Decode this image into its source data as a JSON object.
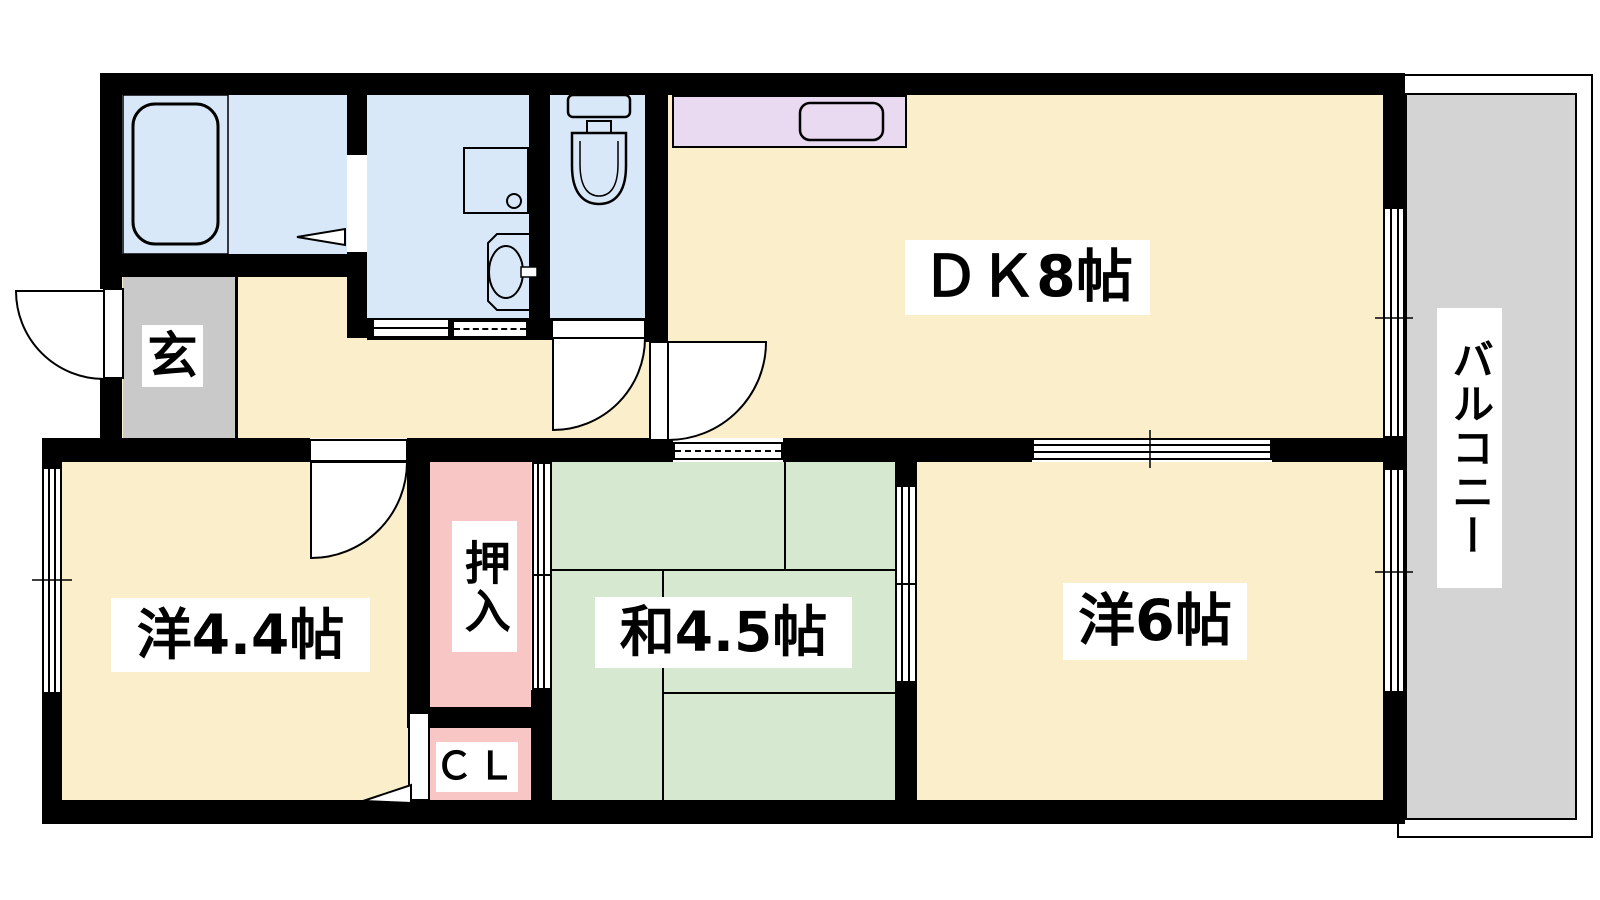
{
  "plan": {
    "kind": "apartment floor plan",
    "rooms": {
      "dk": {
        "label": "ＤＫ8帖",
        "tatami": 8
      },
      "western_4_4": {
        "label": "洋4.4帖",
        "tatami": 4.4
      },
      "japanese_4_5": {
        "label": "和4.5帖",
        "tatami": 4.5
      },
      "western_6": {
        "label": "洋6帖",
        "tatami": 6
      },
      "genkan": {
        "label": "玄"
      },
      "oshiire": {
        "label": "押入"
      },
      "closet": {
        "label": "ＣＬ"
      },
      "balcony": {
        "label": "バルコニー"
      }
    },
    "fixtures": [
      "bathtub",
      "washbasin",
      "washing-machine-pan",
      "toilet",
      "kitchen-counter",
      "kitchen-sink",
      "entrance-door",
      "bathroom-door-marker",
      "toilet-door",
      "dk-door",
      "room-door",
      "closet-door",
      "sliding-windows",
      "fusuma-sliding-doors"
    ],
    "colors": {
      "wall": "#000000",
      "floor_cream": "#FAEECB",
      "wet_blue": "#D9E8F8",
      "tatami_green": "#D6E8CF",
      "closet_pink": "#F9C6C6",
      "genkan_gray": "#C9C9C9",
      "counter_lavender": "#E9D9F1",
      "balcony_gray": "#D4D4D4",
      "label_bg": "#FFFFFF"
    }
  }
}
